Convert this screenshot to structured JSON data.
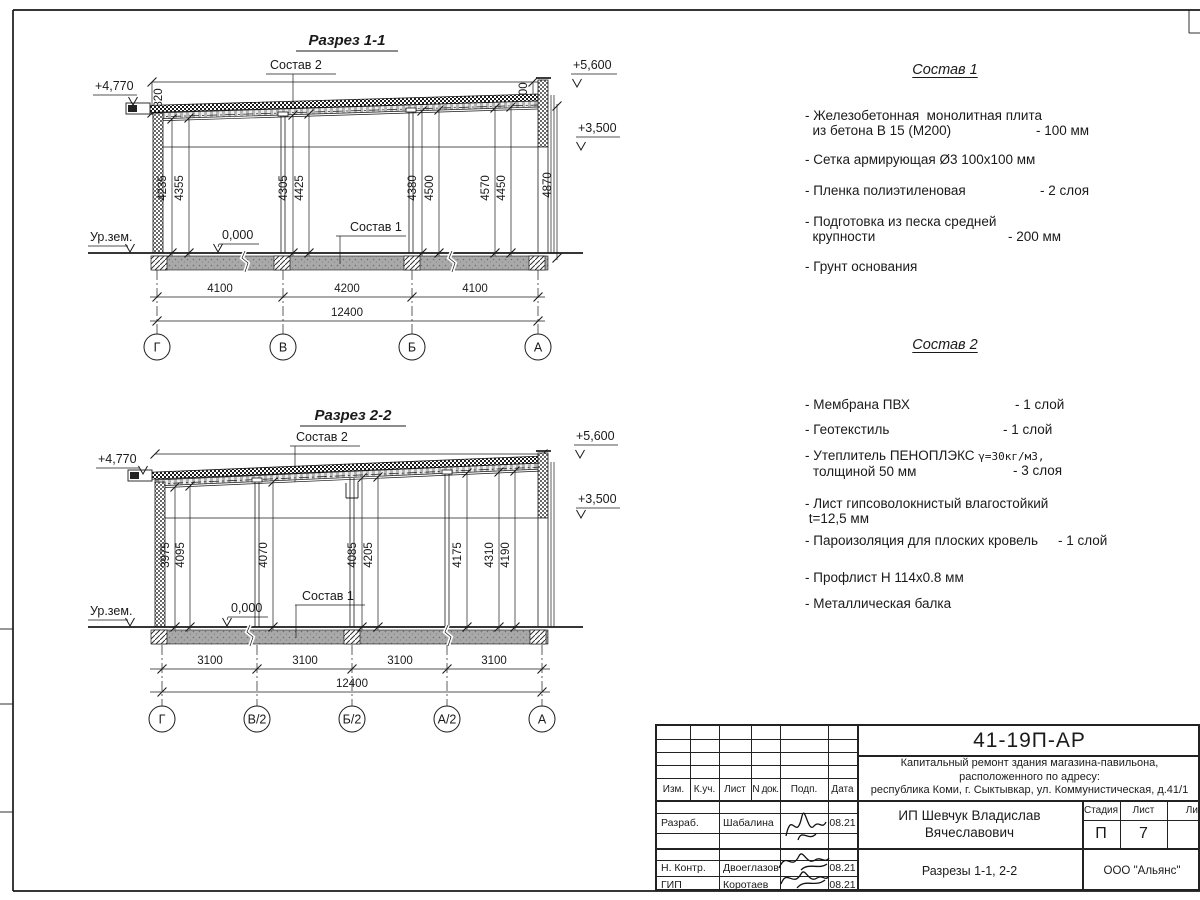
{
  "section1": {
    "title": "Разрез 1-1",
    "label_sostav2": "Состав 2",
    "label_sostav1": "Состав 1",
    "elev_left": "+4,770",
    "elev_right_top": "+5,600",
    "elev_right_mid": "+3,500",
    "ground_label": "Ур.зем.",
    "zero_label": "0,000",
    "dim_parapet_left": "820",
    "dim_parapet_right": "600",
    "vdims": [
      "4235",
      "4355",
      "4305",
      "4425",
      "4380",
      "4500",
      "4570",
      "4450",
      "4870"
    ],
    "hdims": [
      "4100",
      "4200",
      "4100"
    ],
    "total_dim": "12400",
    "axes": [
      "Г",
      "В",
      "Б",
      "А"
    ]
  },
  "section2": {
    "title": "Разрез 2-2",
    "label_sostav2": "Состав 2",
    "label_sostav1": "Состав 1",
    "elev_left": "+4,770",
    "elev_right_top": "+5,600",
    "elev_right_mid": "+3,500",
    "ground_label": "Ур.зем.",
    "zero_label": "0,000",
    "vdims": [
      "3975",
      "4095",
      "4070",
      "4085",
      "4205",
      "4175",
      "4310",
      "4190"
    ],
    "hdims": [
      "3100",
      "3100",
      "3100",
      "3100"
    ],
    "total_dim": "12400",
    "axes": [
      "Г",
      "В/2",
      "Б/2",
      "А/2",
      "А"
    ]
  },
  "sostav1": {
    "title": "Состав 1",
    "items": [
      {
        "name": "- Железобетонная  монолитная плита\n  из бетона В 15 (М200)",
        "value": "- 100 мм"
      },
      {
        "name": "- Сетка армирующая Ø3 100х100 мм",
        "value": ""
      },
      {
        "name": "- Пленка полиэтиленовая",
        "value": "- 2 слоя"
      },
      {
        "name": "- Подготовка из песка средней\n  крупности",
        "value": "- 200 мм"
      },
      {
        "name": "- Грунт основания",
        "value": ""
      }
    ]
  },
  "sostav2": {
    "title": "Состав 2",
    "items": [
      {
        "name": "- Мембрана ПВХ",
        "value": "- 1 слой"
      },
      {
        "name": "- Геотекстиль",
        "value": "- 1 слой"
      },
      {
        "name_a": "- Утеплитель ПЕНОПЛЭКС ",
        "name_b": "γ=30кг/м3,",
        "name_c": "толщиной 50 мм",
        "value": "- 3 слоя"
      },
      {
        "name": "- Лист гипсоволокнистый влагостойкий\n t=12,5 мм",
        "value": ""
      },
      {
        "name": "- Пароизоляция для плоских кровель",
        "value": "- 1 слой"
      },
      {
        "name": "- Профлист Н 114х0.8 мм",
        "value": ""
      },
      {
        "name": "- Металлическая балка",
        "value": ""
      }
    ]
  },
  "titleblock": {
    "doc_number": "41-19П-АР",
    "project_line1": "Капитальный ремонт здания магазина-павильона,",
    "project_line2": "расположенного по адресу:",
    "project_line3": "республика Коми, г. Сыктывкар, ул. Коммунистическая, д.41/1",
    "col_izm": "Изм.",
    "col_kuch": "К.уч.",
    "col_list": "Лист",
    "col_ndok": "N док.",
    "col_podp": "Подп.",
    "col_data": "Дата",
    "row_razrab_role": "Разраб.",
    "row_razrab_name": "Шабалина",
    "row_razrab_date": "08.21",
    "row_nkontr_role": "Н. Контр.",
    "row_nkontr_name": "Двоеглазов",
    "row_nkontr_date": "08.21",
    "row_gip_role": "ГИП",
    "row_gip_name": "Коротаев",
    "row_gip_date": "08.21",
    "client": "ИП Шевчук Владислав\nВячеславович",
    "stage_label": "Стадия",
    "sheet_label": "Лист",
    "sheets_label": "Листов",
    "stage_value": "П",
    "sheet_value": "7",
    "drawing_title": "Разрезы 1-1, 2-2",
    "company": "ООО \"Альянс\""
  }
}
